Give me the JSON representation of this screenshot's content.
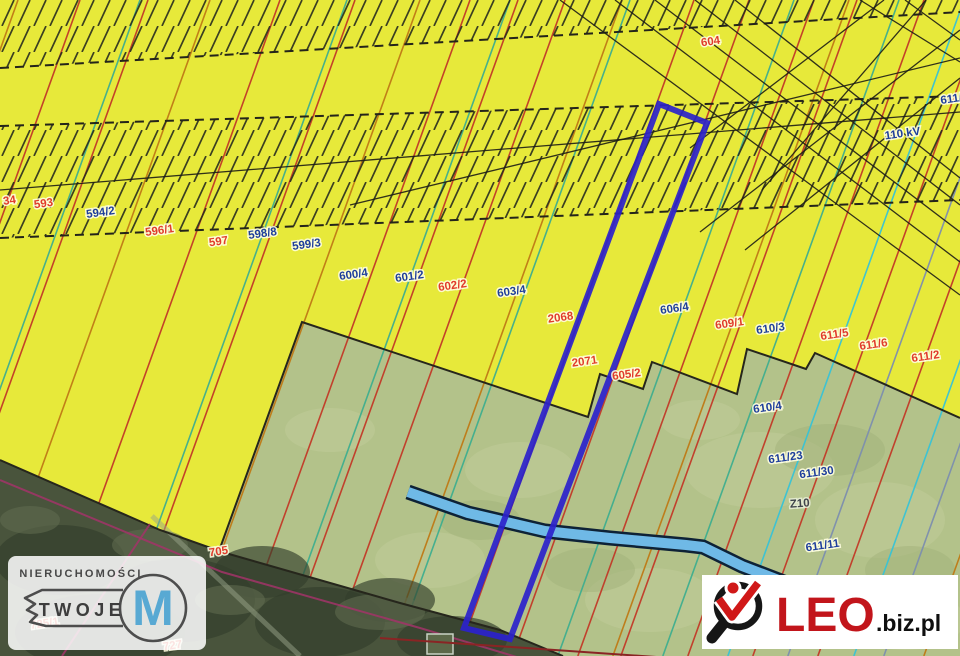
{
  "map": {
    "colors": {
      "olive": "#b3c28a",
      "olive_light": "#c3cf9c",
      "olive_dark": "#a2b27a",
      "yellow": "#e7e93a",
      "forest": "#49543c",
      "forest_dark": "#333d2b",
      "forest_light": "#5f6b4e",
      "hatch": "#282c1e",
      "dash": "#24241a",
      "power": "#1d1d16",
      "boundary": "#26261c",
      "stream_fill": "#6fb9e6",
      "stream_edge": "#0e2236",
      "parcel_blue": "#2b22cc",
      "magenta": "#a23468",
      "path_gray": "#98a489",
      "red_line": "#8a2424",
      "line_r": "#c23a28",
      "line_o": "#bf7a16",
      "line_t": "#3fae8f",
      "line_c": "#38c3d6",
      "line_s": "#7d8fae"
    },
    "yellow_region": [
      [
        0,
        0
      ],
      [
        960,
        0
      ],
      [
        960,
        418
      ],
      [
        815,
        353
      ],
      [
        806,
        369
      ],
      [
        747,
        349
      ],
      [
        737,
        394
      ],
      [
        652,
        362
      ],
      [
        643,
        389
      ],
      [
        600,
        374
      ],
      [
        588,
        417
      ],
      [
        302,
        322
      ],
      [
        215,
        562
      ],
      [
        0,
        460
      ]
    ],
    "boundary_path": [
      [
        960,
        418
      ],
      [
        815,
        353
      ],
      [
        806,
        369
      ],
      [
        747,
        349
      ],
      [
        737,
        394
      ],
      [
        652,
        362
      ],
      [
        643,
        389
      ],
      [
        600,
        374
      ],
      [
        588,
        417
      ],
      [
        302,
        322
      ],
      [
        215,
        562
      ]
    ],
    "forest_region": [
      [
        0,
        460
      ],
      [
        160,
        530
      ],
      [
        222,
        552
      ],
      [
        400,
        603
      ],
      [
        500,
        630
      ],
      [
        563,
        656
      ],
      [
        0,
        656
      ]
    ],
    "hatch_bands": [
      [
        [
          0,
          0
        ],
        [
          960,
          0
        ],
        [
          960,
          12
        ],
        [
          0,
          68
        ]
      ],
      [
        [
          0,
          126
        ],
        [
          960,
          96
        ],
        [
          960,
          200
        ],
        [
          0,
          238
        ]
      ]
    ],
    "dashed_lines": [
      [
        0,
        68,
        960,
        12
      ],
      [
        0,
        126,
        960,
        96
      ],
      [
        0,
        238,
        960,
        200
      ]
    ],
    "strip_slope": 0.36,
    "strip_lines": [
      [
        18,
        "o"
      ],
      [
        80,
        "r"
      ],
      [
        140,
        "t"
      ],
      [
        148,
        "r"
      ],
      [
        210,
        "o"
      ],
      [
        280,
        "r"
      ],
      [
        347,
        "t"
      ],
      [
        355,
        "r"
      ],
      [
        420,
        "o"
      ],
      [
        470,
        "r"
      ],
      [
        510,
        "t"
      ],
      [
        518,
        "r"
      ],
      [
        565,
        "r"
      ],
      [
        622,
        "o"
      ],
      [
        630,
        "t"
      ],
      [
        694,
        "r"
      ],
      [
        749,
        "r"
      ],
      [
        794,
        "t"
      ],
      [
        814,
        "r"
      ],
      [
        849,
        "o"
      ],
      [
        857,
        "r"
      ],
      [
        899,
        "t"
      ],
      [
        924,
        "r"
      ],
      [
        964,
        "c"
      ],
      [
        989,
        "r"
      ],
      [
        1024,
        "s"
      ],
      [
        1054,
        "r"
      ],
      [
        1090,
        "c"
      ],
      [
        1120,
        "s"
      ],
      [
        1160,
        "o"
      ],
      [
        1200,
        "c"
      ]
    ],
    "power_lines": [
      [
        0,
        190,
        960,
        112
      ],
      [
        350,
        205,
        960,
        58
      ],
      [
        615,
        0,
        960,
        262
      ],
      [
        655,
        0,
        960,
        232
      ],
      [
        695,
        0,
        960,
        205
      ],
      [
        735,
        0,
        960,
        178
      ],
      [
        560,
        0,
        960,
        295
      ],
      [
        700,
        232,
        960,
        30
      ],
      [
        745,
        250,
        960,
        78
      ],
      [
        690,
        148,
        884,
        0
      ],
      [
        762,
        190,
        926,
        0
      ],
      [
        860,
        0,
        960,
        62
      ],
      [
        905,
        0,
        960,
        40
      ]
    ],
    "stream": {
      "points": [
        [
          408,
          492
        ],
        [
          468,
          513
        ],
        [
          545,
          531
        ],
        [
          610,
          538
        ],
        [
          686,
          545
        ],
        [
          703,
          547
        ],
        [
          742,
          566
        ],
        [
          802,
          589
        ],
        [
          846,
          608
        ]
      ],
      "width": 10,
      "casing": 15
    },
    "highlight_parcel": [
      [
        659,
        104
      ],
      [
        707,
        123
      ],
      [
        510,
        639
      ],
      [
        464,
        628
      ]
    ],
    "labels": [
      {
        "t": "34",
        "x": 10,
        "y": 204,
        "c": "red"
      },
      {
        "t": "593",
        "x": 44,
        "y": 207,
        "c": "red"
      },
      {
        "t": "594/2",
        "x": 101,
        "y": 216,
        "c": "navy"
      },
      {
        "t": "596/1",
        "x": 160,
        "y": 234,
        "c": "red"
      },
      {
        "t": "597",
        "x": 219,
        "y": 245,
        "c": "red"
      },
      {
        "t": "598/8",
        "x": 263,
        "y": 237,
        "c": "navy"
      },
      {
        "t": "599/3",
        "x": 307,
        "y": 248,
        "c": "navy"
      },
      {
        "t": "600/4",
        "x": 354,
        "y": 278,
        "c": "navy"
      },
      {
        "t": "601/2",
        "x": 410,
        "y": 280,
        "c": "navy"
      },
      {
        "t": "602/2",
        "x": 453,
        "y": 289,
        "c": "red"
      },
      {
        "t": "603/4",
        "x": 512,
        "y": 295,
        "c": "navy"
      },
      {
        "t": "2068",
        "x": 561,
        "y": 321,
        "c": "red"
      },
      {
        "t": "2071",
        "x": 585,
        "y": 365,
        "c": "red"
      },
      {
        "t": "605/2",
        "x": 627,
        "y": 378,
        "c": "red"
      },
      {
        "t": "604",
        "x": 711,
        "y": 45,
        "c": "red"
      },
      {
        "t": "606/4",
        "x": 675,
        "y": 312,
        "c": "navy"
      },
      {
        "t": "609/1",
        "x": 730,
        "y": 327,
        "c": "red"
      },
      {
        "t": "610/3",
        "x": 771,
        "y": 332,
        "c": "navy"
      },
      {
        "t": "611/5",
        "x": 835,
        "y": 338,
        "c": "red"
      },
      {
        "t": "611/6",
        "x": 874,
        "y": 348,
        "c": "red"
      },
      {
        "t": "611/2",
        "x": 926,
        "y": 360,
        "c": "red"
      },
      {
        "t": "611/1",
        "x": 941,
        "y": 104,
        "c": "navy",
        "anchor": "start"
      },
      {
        "t": "110 kV",
        "x": 903,
        "y": 137,
        "c": "navy",
        "size": 13
      },
      {
        "t": "610/4",
        "x": 768,
        "y": 411,
        "c": "navy"
      },
      {
        "t": "611/23",
        "x": 786,
        "y": 461,
        "c": "navy"
      },
      {
        "t": "611/30",
        "x": 817,
        "y": 476,
        "c": "navy"
      },
      {
        "t": "Z10",
        "x": 800,
        "y": 507,
        "c": "dark",
        "size": 17,
        "rot": -4
      },
      {
        "t": "611/11",
        "x": 823,
        "y": 549,
        "c": "navy"
      },
      {
        "t": "705",
        "x": 219,
        "y": 555,
        "c": "red"
      },
      {
        "t": "725/1",
        "x": 45,
        "y": 627,
        "c": "red"
      },
      {
        "t": "727",
        "x": 173,
        "y": 649,
        "c": "red"
      }
    ],
    "misc": {
      "building": [
        427,
        634,
        26,
        20
      ],
      "magenta_lines": [
        [
          [
            0,
            480
          ],
          [
            222,
            572
          ],
          [
            420,
            628
          ],
          [
            520,
            658
          ]
        ],
        [
          [
            150,
            524
          ],
          [
            62,
            656
          ]
        ]
      ],
      "gray_path": [
        [
          152,
          516
        ],
        [
          300,
          656
        ]
      ],
      "red_bottom_line": [
        [
          380,
          638
        ],
        [
          700,
          660
        ]
      ],
      "blobs_olive_light": [
        [
          520,
          470,
          55,
          28
        ],
        [
          760,
          470,
          75,
          38
        ],
        [
          650,
          600,
          65,
          32
        ],
        [
          880,
          520,
          65,
          38
        ],
        [
          330,
          430,
          45,
          22
        ],
        [
          430,
          560,
          55,
          28
        ],
        [
          905,
          620,
          60,
          30
        ],
        [
          700,
          420,
          40,
          20
        ]
      ],
      "blobs_olive_dark": [
        [
          590,
          570,
          45,
          22
        ],
        [
          830,
          450,
          55,
          26
        ],
        [
          480,
          520,
          40,
          20
        ],
        [
          910,
          570,
          45,
          24
        ]
      ],
      "blobs_forest_dark": [
        [
          60,
          560,
          65,
          35
        ],
        [
          180,
          600,
          75,
          42
        ],
        [
          320,
          622,
          65,
          35
        ],
        [
          100,
          632,
          85,
          38
        ],
        [
          262,
          572,
          48,
          26
        ],
        [
          452,
          640,
          55,
          24
        ],
        [
          390,
          600,
          45,
          22
        ]
      ],
      "blobs_forest_light": [
        [
          150,
          545,
          38,
          16
        ],
        [
          380,
          612,
          45,
          18
        ],
        [
          30,
          520,
          30,
          14
        ],
        [
          230,
          600,
          35,
          15
        ]
      ]
    }
  },
  "watermarks": {
    "left": {
      "line1": "NIERUCHOMOŚCI",
      "line2": "TWOJE",
      "letter": "M"
    },
    "right": {
      "brand": "LEO",
      "suffix": ".biz.pl"
    }
  }
}
